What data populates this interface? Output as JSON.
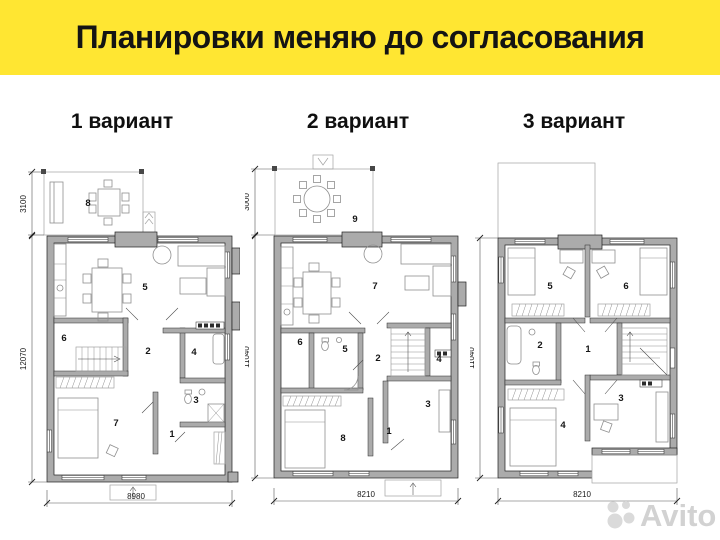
{
  "header": {
    "title": "Планировки меняю до согласования",
    "bg_color": "#ffe632"
  },
  "variants": [
    {
      "label": "1 вариант"
    },
    {
      "label": "2 вариант"
    },
    {
      "label": "3 вариант"
    }
  ],
  "plans": [
    {
      "terrace_dim": "3100",
      "height_dim": "12070",
      "width_dim": "8980",
      "rooms": {
        "r1": "1",
        "r2": "2",
        "r3": "3",
        "r4": "4",
        "r5": "5",
        "r6": "6",
        "r7": "7",
        "r8": "8"
      }
    },
    {
      "terrace_dim": "3000",
      "height_dim": "11040",
      "width_dim": "8210",
      "rooms": {
        "r1": "1",
        "r2": "2",
        "r3": "3",
        "r4": "4",
        "r5": "5",
        "r6": "6",
        "r7": "7",
        "r8": "8",
        "r9": "9"
      }
    },
    {
      "height_dim": "11040",
      "width_dim": "8210",
      "rooms": {
        "r1": "1",
        "r2": "2",
        "r3": "3",
        "r4": "4",
        "r5": "5",
        "r6": "6"
      }
    }
  ],
  "watermark": {
    "text": "Avito"
  },
  "colors": {
    "wall_gray": "#ababab",
    "accent_yellow": "#ffe632"
  }
}
